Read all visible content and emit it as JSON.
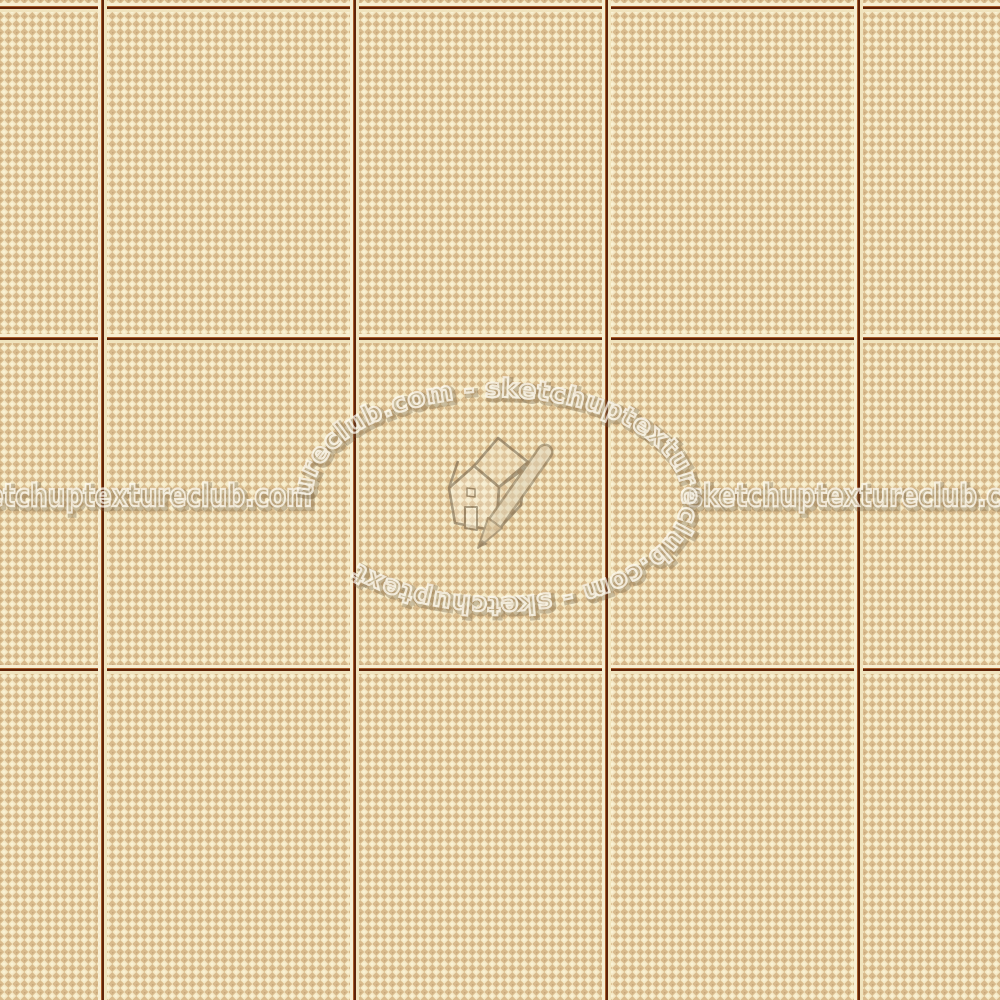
{
  "page": {
    "type": "seamless-texture-photo",
    "subject": "cream checkerboard ceramic floor tiles"
  },
  "watermark": {
    "site": "sketchuptextureclub.com",
    "horizontal_text_left": "sketchuptextureclub.com",
    "horizontal_text_right": "sketchuptextureclub.com",
    "ring_text": "ureclub.com  -  sketchuptextureclub.com  -  sketchuptext",
    "logo": "sketchup-house-pencil"
  },
  "texture": {
    "pattern": "diagonal pin-check diamonds, 8px repeat",
    "colors": {
      "cream": "#f4e8c4",
      "tan": "#d8ba8c",
      "dot_accent": "#9e784e",
      "grout_dark": "#5f2309",
      "grout_warm": "#a55a28",
      "grout_bevel": "#f7eed2"
    },
    "grid": {
      "columns_visible": 5,
      "rows_visible": 3,
      "vertical_grout_x": [
        102,
        354,
        606,
        858
      ],
      "horizontal_grout_y": [
        4,
        339,
        670
      ],
      "tile_width_px": 252,
      "tile_height_px": 333
    }
  }
}
